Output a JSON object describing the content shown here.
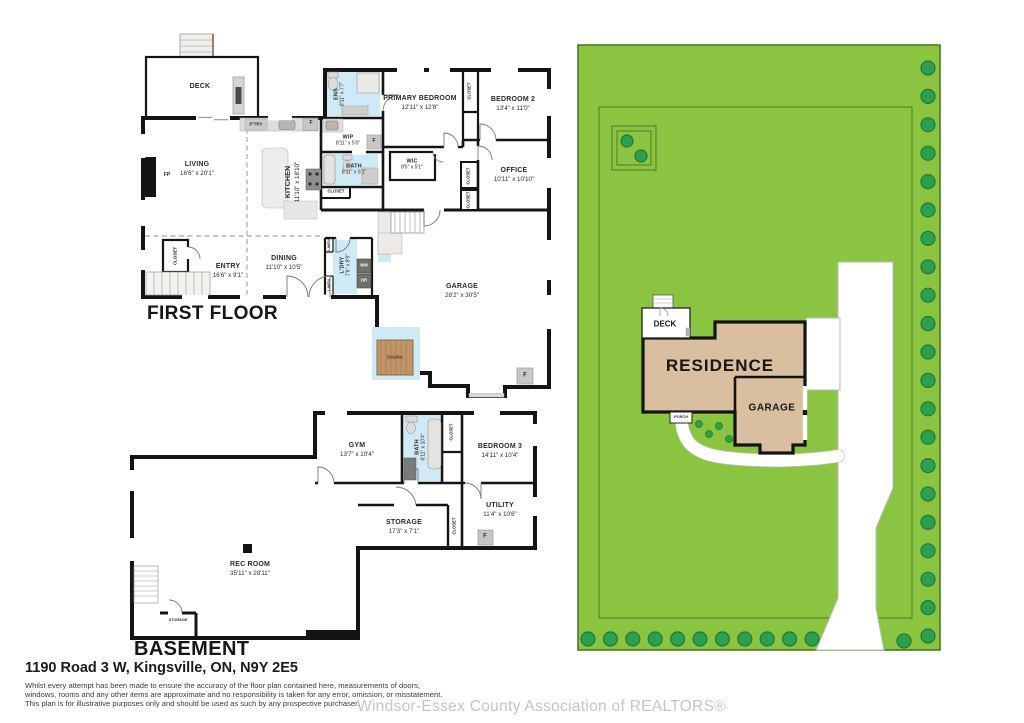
{
  "titles": {
    "first_floor": "FIRST FLOOR",
    "basement": "BASEMENT"
  },
  "first_floor": {
    "rooms": [
      {
        "name": "DECK",
        "dims": ""
      },
      {
        "name": "LIVING",
        "dims": "16'6\" x 20'1\""
      },
      {
        "name": "KITCHEN",
        "dims": "11'10\" x 18'10\""
      },
      {
        "name": "ENS",
        "dims": "8'11\" x 7'7\""
      },
      {
        "name": "PRIMARY BEDROOM",
        "dims": "12'11\" x 12'8\""
      },
      {
        "name": "BEDROOM 2",
        "dims": "13'4\" x 11'0\""
      },
      {
        "name": "WIP",
        "dims": "8'11\" x 5'0\""
      },
      {
        "name": "WIC",
        "dims": "8'5\" x 5'1\""
      },
      {
        "name": "BATH",
        "dims": "8'11\" x 5'1\""
      },
      {
        "name": "OFFICE",
        "dims": "10'11\" x 10'10\""
      },
      {
        "name": "ENTRY",
        "dims": "16'6\" x 9'1\""
      },
      {
        "name": "DINING",
        "dims": "11'10\" x 10'5\""
      },
      {
        "name": "L'DRY",
        "dims": "7'6\" x 8'9\""
      },
      {
        "name": "GARAGE",
        "dims": "28'2\" x 30'5\""
      },
      {
        "name": "SAUNA",
        "dims": ""
      }
    ]
  },
  "basement": {
    "rooms": [
      {
        "name": "GYM",
        "dims": "13'7\" x 10'4\""
      },
      {
        "name": "BATH",
        "dims": "6'11\" x 10'4\""
      },
      {
        "name": "BEDROOM 3",
        "dims": "14'11\" x 10'4\""
      },
      {
        "name": "UTILITY",
        "dims": "11'4\" x 10'6\""
      },
      {
        "name": "STORAGE",
        "dims": "17'3\" x 7'1\""
      },
      {
        "name": "REC ROOM",
        "dims": "35'11\" x 28'11\""
      },
      {
        "name": "STORAGE",
        "dims": ""
      }
    ]
  },
  "labels": {
    "closet": "CLOSET",
    "linen": "LINEN",
    "washer": "WM",
    "dryer": "DR",
    "fridge": "F",
    "fireplace": "FP",
    "pantry": "P'TRY"
  },
  "site_plan": {
    "residence": "RESIDENCE",
    "garage": "GARAGE",
    "deck": "DECK",
    "porch": "PORCH"
  },
  "footer": {
    "address": "1190 Road 3 W, Kingsville, ON, N9Y 2E5",
    "disclaimer": [
      "Whilst every attempt has been made to ensure the accuracy of the floor plan contained here, measurements of doors,",
      "windows, rooms and any other items are approximate and no responsibility is taken for any error, omission, or misstatement.",
      "This plan is for illustrative purposes only and should be used as such by any prospective purchaser."
    ],
    "watermark": "Windsor-Essex County Association of REALTORS®"
  },
  "colors": {
    "lot_green": "#8bc440",
    "tree_green": "#2e9e4f",
    "building_tan": "#d9bf9f",
    "plan_blue": "#cfe9f5",
    "sauna_wood": "#c2946a",
    "wall_black": "#141414",
    "watermark_gray": "#c5c8ca"
  }
}
